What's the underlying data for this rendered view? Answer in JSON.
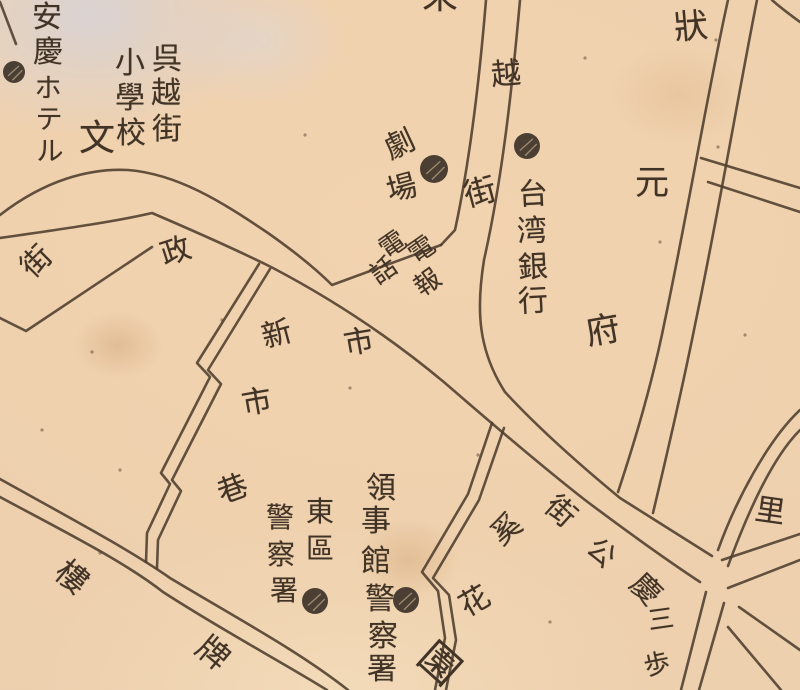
{
  "map": {
    "title": "Historical city map fragment (hand-drawn street map with Japanese labels)",
    "colors": {
      "paper": "#f0d1ae",
      "pale_stain": "#d7d3d7",
      "brown_stain": "#c18e58",
      "road_line": "#4d3d2e",
      "ink": "#413325",
      "poi_fill": "#3d3228",
      "poi_hatch": "#e6cda7"
    },
    "labels": [
      {
        "id": "anqing-hotel",
        "text": "安慶ホテル",
        "chars": [
          {
            "ch": "安",
            "x": 47,
            "y": 18,
            "size": 30,
            "rot": 0
          },
          {
            "ch": "慶",
            "x": 48,
            "y": 53,
            "size": 30,
            "rot": 0
          },
          {
            "ch": "ホ",
            "x": 48,
            "y": 89,
            "size": 27,
            "rot": 0
          },
          {
            "ch": "テ",
            "x": 49,
            "y": 120,
            "size": 27,
            "rot": 0
          },
          {
            "ch": "ル",
            "x": 50,
            "y": 152,
            "size": 27,
            "rot": 0
          }
        ]
      },
      {
        "id": "wuyue-street-school",
        "text": "呉越街小學校",
        "chars": [
          {
            "ch": "呉",
            "x": 167,
            "y": 60,
            "size": 30,
            "rot": 0
          },
          {
            "ch": "越",
            "x": 166,
            "y": 94,
            "size": 30,
            "rot": 0
          },
          {
            "ch": "街",
            "x": 167,
            "y": 130,
            "size": 30,
            "rot": 0
          },
          {
            "ch": "小",
            "x": 130,
            "y": 64,
            "size": 30,
            "rot": 0
          },
          {
            "ch": "學",
            "x": 130,
            "y": 99,
            "size": 30,
            "rot": 0
          },
          {
            "ch": "校",
            "x": 131,
            "y": 134,
            "size": 30,
            "rot": 0
          }
        ]
      },
      {
        "id": "school-mark",
        "text": "文",
        "chars": [
          {
            "ch": "文",
            "x": 97,
            "y": 139,
            "size": 36,
            "rot": 0
          }
        ]
      },
      {
        "id": "top-edge-partial-char",
        "text": "來",
        "chars": [
          {
            "ch": "來",
            "x": 440,
            "y": -3,
            "size": 36,
            "rot": 0
          }
        ]
      },
      {
        "id": "yue-street-name",
        "text": "越街",
        "chars": [
          {
            "ch": "越",
            "x": 506,
            "y": 75,
            "size": 30,
            "rot": -5
          },
          {
            "ch": "街",
            "x": 480,
            "y": 192,
            "size": 32,
            "rot": -15
          }
        ]
      },
      {
        "id": "theater",
        "text": "劇場",
        "chars": [
          {
            "ch": "劇",
            "x": 400,
            "y": 145,
            "size": 30,
            "rot": -25
          },
          {
            "ch": "場",
            "x": 402,
            "y": 189,
            "size": 30,
            "rot": -15
          }
        ]
      },
      {
        "id": "telegraph-telephone",
        "text": "電報電話",
        "chars": [
          {
            "ch": "電",
            "x": 422,
            "y": 250,
            "size": 26,
            "rot": -35
          },
          {
            "ch": "報",
            "x": 428,
            "y": 283,
            "size": 26,
            "rot": -35
          },
          {
            "ch": "電",
            "x": 393,
            "y": 245,
            "size": 26,
            "rot": -35
          },
          {
            "ch": "話",
            "x": 384,
            "y": 271,
            "size": 26,
            "rot": -35
          }
        ]
      },
      {
        "id": "bank-of-taiwan",
        "text": "台湾銀行",
        "chars": [
          {
            "ch": "台",
            "x": 533,
            "y": 195,
            "size": 30,
            "rot": -3
          },
          {
            "ch": "湾",
            "x": 532,
            "y": 232,
            "size": 30,
            "rot": -3
          },
          {
            "ch": "銀",
            "x": 533,
            "y": 268,
            "size": 30,
            "rot": -3
          },
          {
            "ch": "行",
            "x": 533,
            "y": 302,
            "size": 30,
            "rot": -3
          }
        ]
      },
      {
        "id": "zhuangyuan-fu",
        "text": "狀元府",
        "chars": [
          {
            "ch": "狀",
            "x": 691,
            "y": 27,
            "size": 34,
            "rot": -5
          },
          {
            "ch": "元",
            "x": 652,
            "y": 183,
            "size": 34,
            "rot": 0
          },
          {
            "ch": "府",
            "x": 603,
            "y": 331,
            "size": 34,
            "rot": -10
          }
        ]
      },
      {
        "id": "zheng-char",
        "text": "政",
        "chars": [
          {
            "ch": "政",
            "x": 176,
            "y": 252,
            "size": 30,
            "rot": -18
          }
        ]
      },
      {
        "id": "shi-char-main-road",
        "text": "市",
        "chars": [
          {
            "ch": "市",
            "x": 359,
            "y": 343,
            "size": 30,
            "rot": -10
          }
        ]
      },
      {
        "id": "stub-street-gai",
        "text": "街",
        "chars": [
          {
            "ch": "街",
            "x": 37,
            "y": 262,
            "size": 30,
            "rot": -45
          }
        ]
      },
      {
        "id": "xinshi-lane-name",
        "text": "新市巷",
        "chars": [
          {
            "ch": "新",
            "x": 277,
            "y": 335,
            "size": 30,
            "rot": -15
          },
          {
            "ch": "市",
            "x": 257,
            "y": 403,
            "size": 30,
            "rot": -10
          },
          {
            "ch": "巷",
            "x": 233,
            "y": 490,
            "size": 30,
            "rot": -20
          }
        ]
      },
      {
        "id": "east-district-police",
        "text": "東區警察署",
        "chars": [
          {
            "ch": "東",
            "x": 320,
            "y": 512,
            "size": 28,
            "rot": 0
          },
          {
            "ch": "區",
            "x": 320,
            "y": 549,
            "size": 28,
            "rot": 0
          },
          {
            "ch": "警",
            "x": 280,
            "y": 518,
            "size": 28,
            "rot": 0
          },
          {
            "ch": "察",
            "x": 281,
            "y": 555,
            "size": 28,
            "rot": 0
          },
          {
            "ch": "署",
            "x": 284,
            "y": 591,
            "size": 28,
            "rot": 0
          }
        ]
      },
      {
        "id": "consulate-police",
        "text": "領事館警察署",
        "chars": [
          {
            "ch": "領",
            "x": 381,
            "y": 489,
            "size": 30,
            "rot": 0
          },
          {
            "ch": "事",
            "x": 376,
            "y": 522,
            "size": 30,
            "rot": 0
          },
          {
            "ch": "館",
            "x": 376,
            "y": 562,
            "size": 30,
            "rot": 0
          },
          {
            "ch": "警",
            "x": 380,
            "y": 600,
            "size": 30,
            "rot": 0
          },
          {
            "ch": "察",
            "x": 383,
            "y": 637,
            "size": 30,
            "rot": 0
          },
          {
            "ch": "署",
            "x": 382,
            "y": 670,
            "size": 30,
            "rot": 0
          }
        ]
      },
      {
        "id": "qinggong-street",
        "text": "慶公街",
        "chars": [
          {
            "ch": "街",
            "x": 560,
            "y": 512,
            "size": 30,
            "rot": 42
          },
          {
            "ch": "公",
            "x": 601,
            "y": 553,
            "size": 28,
            "rot": 42
          },
          {
            "ch": "慶",
            "x": 645,
            "y": 590,
            "size": 30,
            "rot": 45
          }
        ]
      },
      {
        "id": "flower-garden",
        "text": "奚花園",
        "chars": [
          {
            "ch": "奚",
            "x": 507,
            "y": 530,
            "size": 30,
            "rot": -40
          },
          {
            "ch": "花",
            "x": 475,
            "y": 602,
            "size": 30,
            "rot": -30
          },
          {
            "ch": "園",
            "x": 439,
            "y": 664,
            "size": 40,
            "rot": 42
          }
        ]
      },
      {
        "id": "sanbu-partial",
        "text": "三歩",
        "chars": [
          {
            "ch": "三",
            "x": 661,
            "y": 620,
            "size": 26,
            "rot": -8
          },
          {
            "ch": "歩",
            "x": 657,
            "y": 665,
            "size": 26,
            "rot": -12
          }
        ]
      },
      {
        "id": "li-char",
        "text": "里",
        "chars": [
          {
            "ch": "里",
            "x": 770,
            "y": 512,
            "size": 30,
            "rot": 8
          }
        ]
      },
      {
        "id": "pailou-road-name",
        "text": "樓牌",
        "chars": [
          {
            "ch": "樓",
            "x": 72,
            "y": 577,
            "size": 32,
            "rot": 40
          },
          {
            "ch": "牌",
            "x": 213,
            "y": 653,
            "size": 32,
            "rot": 40
          }
        ]
      }
    ],
    "poi_symbols": [
      {
        "id": "hotel-poi",
        "x": 14,
        "y": 72,
        "r": 11
      },
      {
        "id": "theater-poi",
        "x": 434,
        "y": 169,
        "r": 14
      },
      {
        "id": "bank-poi",
        "x": 527,
        "y": 146,
        "r": 13
      },
      {
        "id": "east-police-poi",
        "x": 315,
        "y": 601,
        "r": 13
      },
      {
        "id": "consulate-police-poi",
        "x": 406,
        "y": 600,
        "r": 13
      }
    ],
    "roads": [
      {
        "id": "main-road-north-edge",
        "d": "M 0,215 C 45,180 90,168 128,170 C 178,174 222,202 268,233 C 295,252 315,268 332,285 L 441,245"
      },
      {
        "id": "yue-street-west-line",
        "d": "M 486,0 C 479,85 469,165 455,230 L 441,245"
      },
      {
        "id": "yue-street-east-and-main-north",
        "d": "M 520,0 C 512,90 502,180 484,260 C 476,310 478,350 505,392 C 540,430 580,465 620,498 L 712,556"
      },
      {
        "id": "main-road-south-edge",
        "d": "M 0,238 C 70,228 118,221 152,213 C 215,240 245,254 273,268 C 330,298 390,337 445,383 C 490,422 540,465 585,500 C 625,530 662,557 700,582"
      },
      {
        "id": "stub-street-south-line",
        "d": "M 0,318 L 26,331 L 152,247"
      },
      {
        "id": "zhuangyuanfu-street-west-line",
        "d": "M 728,0 C 710,80 690,200 665,320 C 655,370 638,432 618,492"
      },
      {
        "id": "zhuangyuanfu-street-east-line",
        "d": "M 757,0 C 740,85 720,205 695,325 C 686,370 668,450 653,513"
      },
      {
        "id": "ne-branch-upper",
        "d": "M 701,158 L 800,188"
      },
      {
        "id": "ne-branch-lower",
        "d": "M 708,182 L 800,212"
      },
      {
        "id": "east-street-upper",
        "d": "M 800,410 C 768,440 736,500 718,550"
      },
      {
        "id": "east-street-lower",
        "d": "M 800,430 C 772,458 748,512 728,566"
      },
      {
        "id": "east-fork-upper",
        "d": "M 722,560 L 800,534"
      },
      {
        "id": "east-fork-lower",
        "d": "M 728,588 L 800,560"
      },
      {
        "id": "south-fork-west",
        "d": "M 706,592 L 681,690"
      },
      {
        "id": "south-fork-east",
        "d": "M 724,603 L 699,690"
      },
      {
        "id": "se-fork-upper",
        "d": "M 739,607 L 800,650"
      },
      {
        "id": "se-fork-lower",
        "d": "M 728,627 L 781,690"
      },
      {
        "id": "pailou-road-north-line",
        "d": "M 0,479 C 70,518 130,550 170,578 C 240,620 300,652 348,690"
      },
      {
        "id": "pailou-road-south-line",
        "d": "M 0,497 C 65,532 125,562 163,592 C 225,632 282,662 327,690"
      },
      {
        "id": "xinshi-lane-east-line",
        "d": "M 270,269 L 208,370 L 221,384 L 172,480 L 181,491 L 158,540 L 157,568"
      },
      {
        "id": "xinshi-lane-west-line",
        "d": "M 259,264 L 197,363 L 210,377 L 161,473 L 170,484 L 147,533 L 146,562"
      },
      {
        "id": "garden-lane-east-line",
        "d": "M 504,428 L 479,500 L 433,578 L 449,595 L 456,640 L 446,690"
      },
      {
        "id": "garden-lane-west-line",
        "d": "M 492,423 L 468,494 L 422,572 L 438,591 L 445,638 L 435,690"
      },
      {
        "id": "corner-line-nw",
        "d": "M 0,2 L 16,44"
      },
      {
        "id": "corner-line-ne",
        "d": "M 772,0 C 782,9 792,16 800,22"
      }
    ],
    "foxing_specks": [
      [
        350,
        388
      ],
      [
        222,
        320
      ],
      [
        718,
        147
      ],
      [
        716,
        40
      ],
      [
        92,
        352
      ],
      [
        550,
        622
      ],
      [
        660,
        242
      ],
      [
        100,
        553
      ],
      [
        305,
        135
      ],
      [
        585,
        58
      ],
      [
        745,
        335
      ],
      [
        120,
        470
      ],
      [
        478,
        455
      ],
      [
        42,
        430
      ]
    ]
  }
}
